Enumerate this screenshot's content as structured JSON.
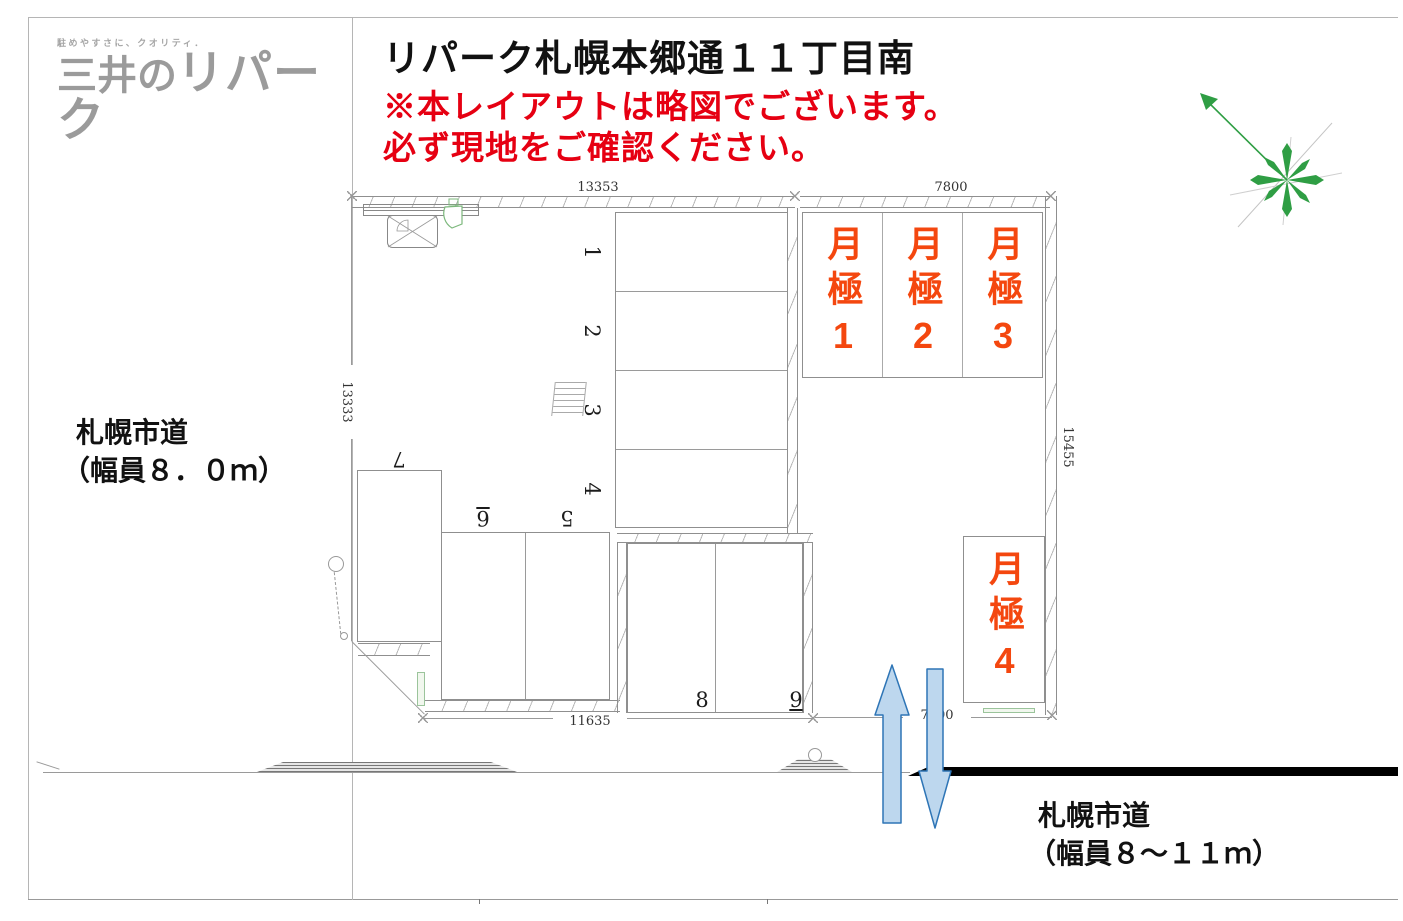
{
  "brand": {
    "tagline": "駐めやすさに、クオリティ．",
    "name_prefix": "三井の",
    "name_main": "リパーク"
  },
  "header": {
    "title": "リパーク札幌本郷通１１丁目南",
    "notice1": "※本レイアウトは略図でございます。",
    "notice2": "必ず現地をご確認ください。"
  },
  "roads": {
    "west_name": "札幌市道",
    "west_width": "（幅員８．０ｍ）",
    "south_name": "札幌市道",
    "south_width": "（幅員８～１１ｍ）"
  },
  "dimensions": {
    "top_left": "13353",
    "top_right": "7800",
    "west": "13333",
    "east": "15455",
    "bottom": "11635",
    "south_gap": "7400"
  },
  "stalls": {
    "numbers": [
      "1",
      "2",
      "3",
      "4",
      "5",
      "6",
      "7",
      "8",
      "9"
    ],
    "monthly": [
      "月極1",
      "月極2",
      "月極3",
      "月極4"
    ]
  },
  "icons": {
    "compass": "compass-north-icon",
    "payment_machine": "payment-machine-icon",
    "signboard": "signboard-icon",
    "flag_sign": "flag-sign-icon",
    "drain_grate": "drain-grate-icon",
    "utility_pole": "utility-pole-icon",
    "traffic_up": "up-arrow-icon",
    "traffic_down": "down-arrow-icon"
  },
  "colors": {
    "monthly_text": "#f4470f",
    "notice": "#e60012",
    "logo": "#9b9b9b",
    "arrow_fill": "#bdd7ee",
    "arrow_stroke": "#2e75b6",
    "compass_green": "#2f9e44"
  }
}
